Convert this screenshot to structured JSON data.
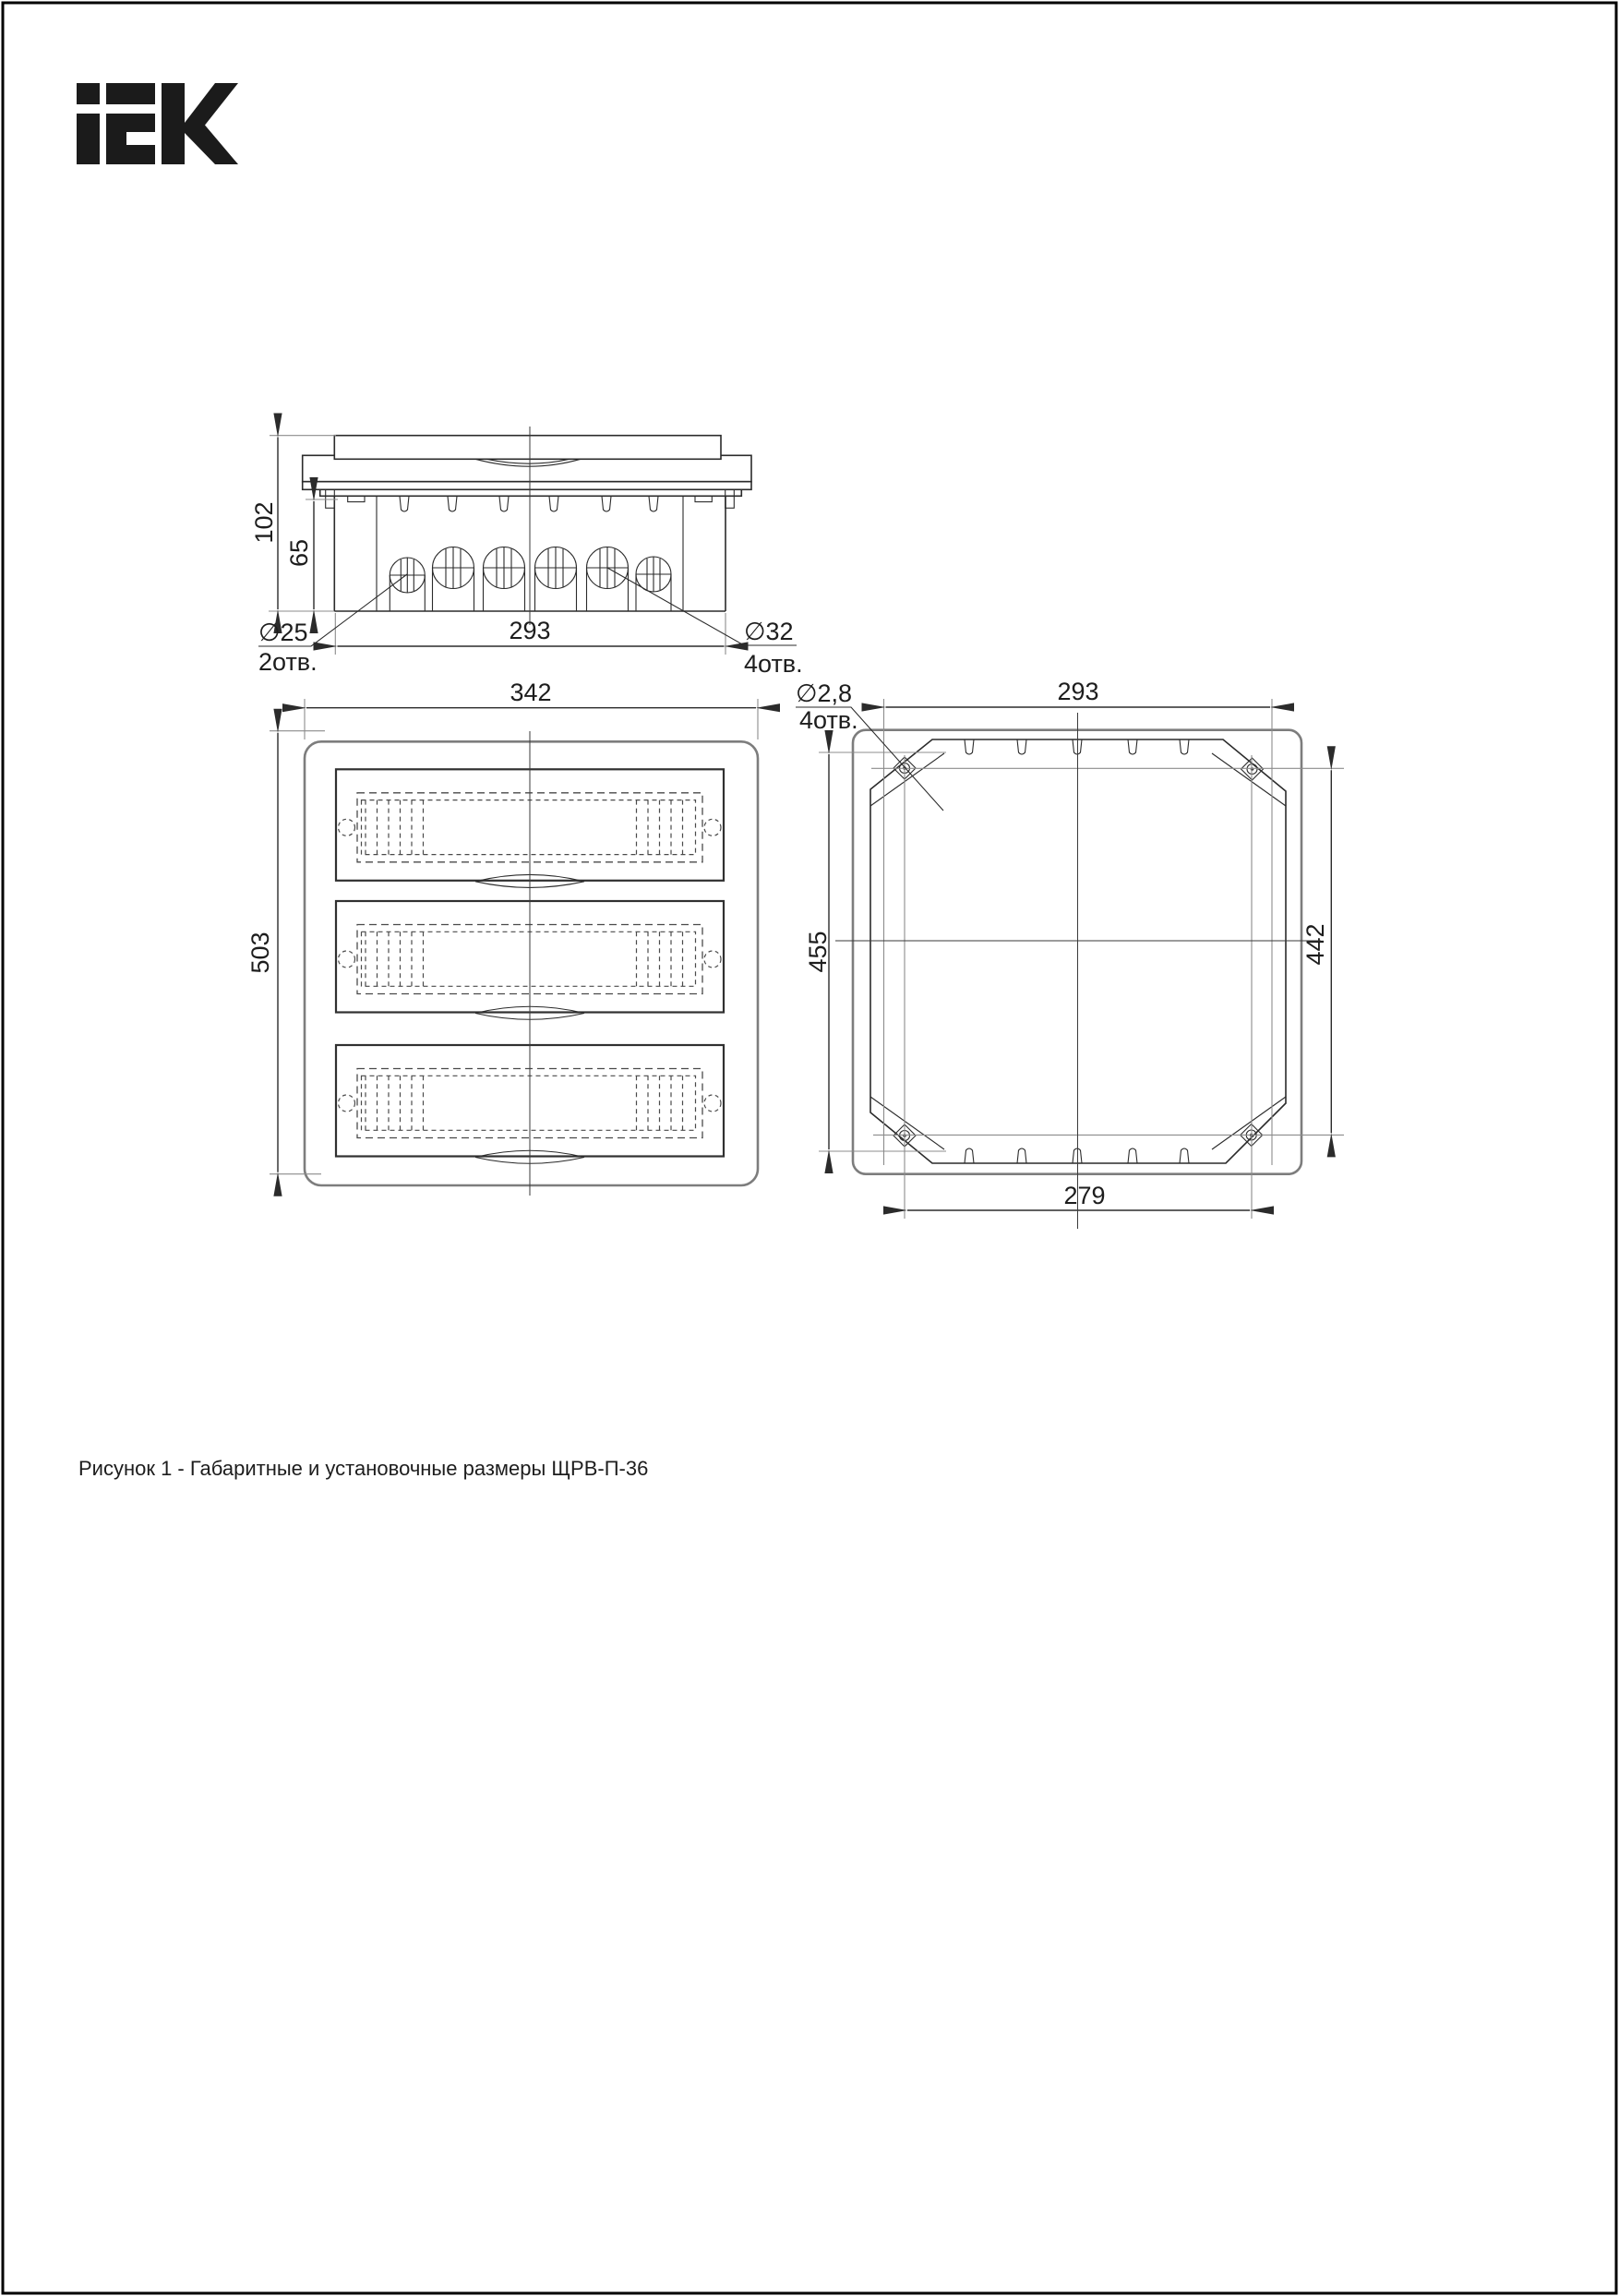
{
  "logo": {
    "label": "IEK"
  },
  "views": {
    "side": {
      "dim_overall_height": "102",
      "dim_inner_height": "65",
      "dim_width": "293",
      "callout_small": {
        "diameter": "∅25",
        "count": "2отв."
      },
      "callout_large": {
        "diameter": "∅32",
        "count": "4отв."
      }
    },
    "front": {
      "dim_width": "342",
      "dim_height": "503"
    },
    "rear": {
      "dim_top_width": "293",
      "dim_left_height": "455",
      "dim_right_height": "442",
      "dim_bottom_width": "279",
      "callout_holes": {
        "diameter": "∅2,8",
        "count": "4отв."
      }
    }
  },
  "caption": "Рисунок 1 - Габаритные и установочные размеры ЩРВ-П-36"
}
